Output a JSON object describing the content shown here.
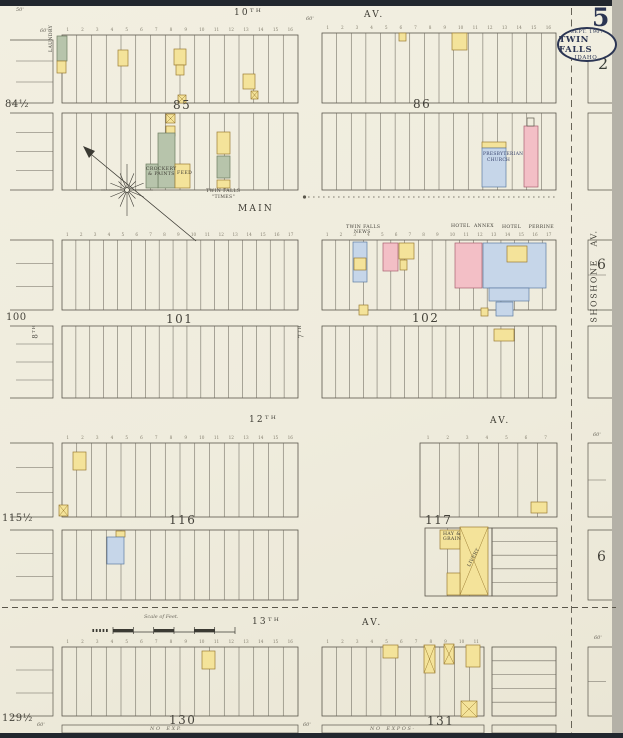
{
  "sheet": {
    "number": "5",
    "adjacent_sheet": "2",
    "stamp": {
      "line1": "SEPT. 1907",
      "line2": "TWIN FALLS",
      "line3": "IDAHO."
    }
  },
  "palette": {
    "paper": "#f0edde",
    "ink": "#5a564b",
    "ink_light": "#6b675c",
    "navy": "#2b3553",
    "yellow": "#f4e39a",
    "yellow_stroke": "#9c7d33",
    "pink": "#f3bfc6",
    "pink_stroke": "#a86070",
    "blue": "#c6d6e9",
    "blue_stroke": "#5d7ca3",
    "green": "#b7c4ab",
    "green_stroke": "#6c7c60"
  },
  "numbers": {
    "n7": [
      "1",
      "2",
      "3",
      "4",
      "5",
      "6",
      "7"
    ],
    "n11": [
      "1",
      "2",
      "3",
      "4",
      "5",
      "6",
      "7",
      "8",
      "9",
      "10",
      "11"
    ],
    "n16": [
      "1",
      "2",
      "3",
      "4",
      "5",
      "6",
      "7",
      "8",
      "9",
      "10",
      "11",
      "12",
      "13",
      "14",
      "15",
      "16"
    ],
    "n17": [
      "1",
      "2",
      "3",
      "4",
      "5",
      "6",
      "7",
      "8",
      "9",
      "10",
      "11",
      "12",
      "13",
      "14",
      "15",
      "16",
      "17"
    ]
  },
  "labels": [
    {
      "n": "street-10th",
      "t": "10ᵀᴴ",
      "x": 234,
      "y": 9,
      "c": "street"
    },
    {
      "n": "street-10th-av",
      "t": "AV.",
      "x": 364,
      "y": 11,
      "c": "street"
    },
    {
      "n": "street-main",
      "t": "MAIN",
      "x": 238,
      "y": 205,
      "c": "street"
    },
    {
      "n": "street-12th",
      "t": "12ᵀᴴ",
      "x": 249,
      "y": 416,
      "c": "street"
    },
    {
      "n": "street-12th-av",
      "t": "AV.",
      "x": 490,
      "y": 417,
      "c": "street"
    },
    {
      "n": "street-13th",
      "t": "13ᵀᴴ",
      "x": 252,
      "y": 618,
      "c": "street"
    },
    {
      "n": "street-13th-av",
      "t": "AV.",
      "x": 362,
      "y": 619,
      "c": "street"
    },
    {
      "n": "street-shoshone",
      "t": "SHOSHONE   AV.",
      "x": 548,
      "y": 272,
      "c": "streetv",
      "r": -90
    },
    {
      "n": "street-7th",
      "t": "7ᵀᴴ",
      "x": 295,
      "y": 328,
      "c": "tinyv",
      "r": -90
    },
    {
      "n": "street-8th",
      "t": "8ᵀᴴ",
      "x": 29,
      "y": 328,
      "c": "tinyv",
      "r": -90
    },
    {
      "n": "block-85",
      "t": "85",
      "x": 173,
      "y": 99,
      "c": "bn"
    },
    {
      "n": "block-86",
      "t": "86",
      "x": 413,
      "y": 98,
      "c": "bn"
    },
    {
      "n": "block-101",
      "t": "101",
      "x": 166,
      "y": 313,
      "c": "bn"
    },
    {
      "n": "block-102",
      "t": "102",
      "x": 412,
      "y": 312,
      "c": "bn"
    },
    {
      "n": "block-116",
      "t": "116",
      "x": 169,
      "y": 514,
      "c": "bn"
    },
    {
      "n": "block-117",
      "t": "117",
      "x": 425,
      "y": 514,
      "c": "bn"
    },
    {
      "n": "block-130",
      "t": "130",
      "x": 169,
      "y": 714,
      "c": "bn"
    },
    {
      "n": "block-131",
      "t": "131",
      "x": 427,
      "y": 715,
      "c": "bn"
    },
    {
      "n": "block-84half",
      "t": "84½",
      "x": 5,
      "y": 100,
      "c": "stub"
    },
    {
      "n": "block-100",
      "t": "100",
      "x": 6,
      "y": 313,
      "c": "stub"
    },
    {
      "n": "block-115half",
      "t": "115½",
      "x": 2,
      "y": 514,
      "c": "stub"
    },
    {
      "n": "block-129half",
      "t": "129½",
      "x": 2,
      "y": 714,
      "c": "stub"
    },
    {
      "n": "block-6-upper",
      "t": "6",
      "x": 597,
      "y": 258,
      "c": "big6"
    },
    {
      "n": "block-6-lower",
      "t": "6",
      "x": 597,
      "y": 550,
      "c": "big6"
    },
    {
      "n": "adjacent-sheet-2",
      "t": "2",
      "x": 598,
      "y": 56,
      "c": "adj"
    },
    {
      "n": "caption-twin-falls-times-1",
      "t": "TWIN FALLS",
      "x": 206,
      "y": 190,
      "c": "cap"
    },
    {
      "n": "caption-twin-falls-times-2",
      "t": "\"TIMES\"",
      "x": 212,
      "y": 196,
      "c": "cap"
    },
    {
      "n": "caption-twin-falls-news-1",
      "t": "TWIN FALLS",
      "x": 346,
      "y": 226,
      "c": "cap"
    },
    {
      "n": "caption-twin-falls-news-2",
      "t": "NEWS",
      "x": 354,
      "y": 231,
      "c": "cap"
    },
    {
      "n": "caption-hotel-annex",
      "t": "HOTEL  ANNEX",
      "x": 451,
      "y": 225,
      "c": "cap"
    },
    {
      "n": "caption-hotel-perrine",
      "t": "HOTEL    PERRINE",
      "x": 502,
      "y": 226,
      "c": "cap"
    },
    {
      "n": "caption-presbyterian-1",
      "t": "PRESBYTERIAN",
      "x": 483,
      "y": 153,
      "c": "capn"
    },
    {
      "n": "caption-presbyterian-2",
      "t": "CHURCH",
      "x": 487,
      "y": 159,
      "c": "capn"
    },
    {
      "n": "caption-hay-grain-1",
      "t": "HAY &",
      "x": 443,
      "y": 533,
      "c": "cap"
    },
    {
      "n": "caption-hay-grain-2",
      "t": "GRAIN",
      "x": 443,
      "y": 538,
      "c": "cap"
    },
    {
      "n": "caption-livery",
      "t": "LIVERY",
      "x": 468,
      "y": 566,
      "c": "cap",
      "r": -62
    },
    {
      "n": "caption-feed",
      "t": "FEED",
      "x": 177,
      "y": 172,
      "c": "cap"
    },
    {
      "n": "caption-crockery-1",
      "t": "CROCKERY",
      "x": 146,
      "y": 168,
      "c": "cap"
    },
    {
      "n": "caption-crockery-2",
      "t": "& PAINTS",
      "x": 148,
      "y": 173,
      "c": "cap"
    },
    {
      "n": "caption-laundry",
      "t": "LAUNDRY",
      "x": 50,
      "y": 52,
      "c": "cap",
      "r": -90
    },
    {
      "n": "caption-no-exp-left",
      "t": "N O    E X P.",
      "x": 150,
      "y": 727,
      "c": "dim"
    },
    {
      "n": "caption-no-expos-right",
      "t": "N O    E X P O S -",
      "x": 370,
      "y": 727,
      "c": "dim"
    },
    {
      "n": "scale-caption",
      "t": "Scale of Feet.",
      "x": 144,
      "y": 615,
      "c": "dim"
    },
    {
      "n": "dim-50ft",
      "t": "50'",
      "x": 16,
      "y": 8,
      "c": "dim"
    },
    {
      "n": "dim-60ft-a",
      "t": "60'",
      "x": 40,
      "y": 29,
      "c": "dim"
    },
    {
      "n": "dim-60ft-b",
      "t": "60'",
      "x": 306,
      "y": 17,
      "c": "dim"
    },
    {
      "n": "dim-60ft-c",
      "t": "60'",
      "x": 37,
      "y": 723,
      "c": "dim"
    },
    {
      "n": "dim-60ft-d",
      "t": "60'",
      "x": 303,
      "y": 723,
      "c": "dim"
    },
    {
      "n": "dim-60ft-e",
      "t": "60'",
      "x": 593,
      "y": 433,
      "c": "dim"
    },
    {
      "n": "dim-60ft-f",
      "t": "60'",
      "x": 594,
      "y": 636,
      "c": "dim"
    }
  ],
  "map": {
    "blocks": [
      {
        "x": 62,
        "y": 35,
        "w": 236,
        "h": 68,
        "lots": 16
      },
      {
        "x": 62,
        "y": 113,
        "w": 236,
        "h": 77,
        "lots": 16
      },
      {
        "x": 322,
        "y": 33,
        "w": 234,
        "h": 70,
        "lots": 16
      },
      {
        "x": 322,
        "y": 113,
        "w": 234,
        "h": 77,
        "lots": 16
      },
      {
        "x": 62,
        "y": 240,
        "w": 236,
        "h": 70,
        "lots": 17
      },
      {
        "x": 62,
        "y": 326,
        "w": 236,
        "h": 72,
        "lots": 17
      },
      {
        "x": 322,
        "y": 240,
        "w": 234,
        "h": 70,
        "lots": 17
      },
      {
        "x": 322,
        "y": 326,
        "w": 234,
        "h": 72,
        "lots": 17
      },
      {
        "x": 62,
        "y": 443,
        "w": 236,
        "h": 74,
        "lots": 16
      },
      {
        "x": 62,
        "y": 530,
        "w": 236,
        "h": 70,
        "lots": 16
      },
      {
        "x": 420,
        "y": 443,
        "w": 137,
        "h": 74,
        "lots": 7
      },
      {
        "x": 425,
        "y": 528,
        "w": 67,
        "h": 68,
        "lots": 3
      },
      {
        "x": 62,
        "y": 647,
        "w": 236,
        "h": 69,
        "lots": 16
      },
      {
        "x": 322,
        "y": 647,
        "w": 162,
        "h": 69,
        "lots": 11
      }
    ],
    "rows_blocks": [
      {
        "x": 492,
        "y": 528,
        "w": 65,
        "h": 68,
        "rows": 5
      },
      {
        "x": 492,
        "y": 647,
        "w": 64,
        "h": 69,
        "rows": 5
      }
    ],
    "strips": [
      {
        "x": 62,
        "y": 725,
        "w": 236,
        "h": 8
      },
      {
        "x": 322,
        "y": 725,
        "w": 162,
        "h": 8
      },
      {
        "x": 492,
        "y": 725,
        "w": 64,
        "h": 8
      }
    ],
    "stubs_left": [
      {
        "x": 10,
        "y": 40,
        "w": 43,
        "h": 63,
        "inner": 2
      },
      {
        "x": 10,
        "y": 113,
        "w": 43,
        "h": 77,
        "inner": 3
      },
      {
        "x": 10,
        "y": 240,
        "w": 43,
        "h": 70,
        "inner": 2
      },
      {
        "x": 10,
        "y": 326,
        "w": 43,
        "h": 72,
        "inner": 3
      },
      {
        "x": 10,
        "y": 443,
        "w": 43,
        "h": 74,
        "inner": 2
      },
      {
        "x": 10,
        "y": 530,
        "w": 43,
        "h": 70,
        "inner": 2
      },
      {
        "x": 10,
        "y": 647,
        "w": 43,
        "h": 69,
        "inner": 2
      }
    ],
    "stubs_right": [
      {
        "x": 588,
        "y": 35,
        "w": 24,
        "h": 68,
        "inner": 0
      },
      {
        "x": 588,
        "y": 113,
        "w": 24,
        "h": 77,
        "inner": 0
      },
      {
        "x": 588,
        "y": 240,
        "w": 24,
        "h": 70,
        "inner": 1
      },
      {
        "x": 588,
        "y": 326,
        "w": 24,
        "h": 72,
        "inner": 0
      },
      {
        "x": 588,
        "y": 443,
        "w": 24,
        "h": 74,
        "inner": 1
      },
      {
        "x": 588,
        "y": 530,
        "w": 24,
        "h": 70,
        "inner": 0
      },
      {
        "x": 588,
        "y": 647,
        "w": 24,
        "h": 69,
        "inner": 1
      }
    ],
    "buildings": [
      [
        57,
        36,
        10,
        25,
        "G",
        0
      ],
      [
        57,
        61,
        9,
        12,
        "Y",
        0
      ],
      [
        118,
        50,
        10,
        16,
        "Y",
        0
      ],
      [
        174,
        49,
        12,
        16,
        "Y",
        0
      ],
      [
        176,
        65,
        8,
        10,
        "Y",
        0
      ],
      [
        243,
        74,
        12,
        15,
        "Y",
        0
      ],
      [
        251,
        91,
        7,
        8,
        "Y",
        1
      ],
      [
        178,
        95,
        8,
        8,
        "Y",
        1
      ],
      [
        166,
        114,
        9,
        9,
        "Y",
        1
      ],
      [
        166,
        126,
        9,
        10,
        "Y",
        0
      ],
      [
        158,
        133,
        17,
        55,
        "G",
        0
      ],
      [
        146,
        164,
        12,
        24,
        "G",
        0
      ],
      [
        175,
        164,
        15,
        24,
        "Y",
        0
      ],
      [
        217,
        132,
        13,
        22,
        "Y",
        0
      ],
      [
        217,
        156,
        13,
        22,
        "G",
        0
      ],
      [
        217,
        180,
        13,
        8,
        "Y",
        0
      ],
      [
        399,
        33,
        7,
        8,
        "Y",
        0
      ],
      [
        452,
        33,
        15,
        17,
        "Y",
        0
      ],
      [
        482,
        142,
        24,
        6,
        "Y",
        0
      ],
      [
        482,
        148,
        24,
        39,
        "B",
        0
      ],
      [
        524,
        126,
        14,
        61,
        "P",
        0
      ],
      [
        527,
        118,
        7,
        8,
        "W",
        0
      ],
      [
        353,
        242,
        14,
        40,
        "B",
        0
      ],
      [
        354,
        258,
        12,
        12,
        "Y",
        0
      ],
      [
        383,
        243,
        15,
        28,
        "P",
        0
      ],
      [
        399,
        243,
        15,
        16,
        "Y",
        0
      ],
      [
        400,
        260,
        7,
        10,
        "Y",
        0
      ],
      [
        455,
        243,
        27,
        45,
        "P",
        0
      ],
      [
        483,
        243,
        63,
        45,
        "B",
        0
      ],
      [
        507,
        246,
        20,
        16,
        "Y",
        0
      ],
      [
        489,
        288,
        40,
        13,
        "B",
        0
      ],
      [
        496,
        302,
        17,
        14,
        "B",
        0
      ],
      [
        481,
        308,
        7,
        8,
        "Y",
        0
      ],
      [
        359,
        305,
        9,
        10,
        "Y",
        0
      ],
      [
        494,
        329,
        20,
        12,
        "Y",
        0
      ],
      [
        73,
        452,
        13,
        18,
        "Y",
        0
      ],
      [
        59,
        505,
        9,
        11,
        "Y",
        1
      ],
      [
        116,
        531,
        9,
        6,
        "Y",
        0
      ],
      [
        107,
        537,
        17,
        27,
        "B",
        0
      ],
      [
        531,
        502,
        16,
        11,
        "Y",
        0
      ],
      [
        440,
        530,
        20,
        19,
        "Y",
        0
      ],
      [
        460,
        527,
        28,
        68,
        "Y",
        1
      ],
      [
        447,
        573,
        13,
        22,
        "Y",
        0
      ],
      [
        202,
        651,
        13,
        18,
        "Y",
        0
      ],
      [
        383,
        645,
        15,
        13,
        "Y",
        0
      ],
      [
        424,
        645,
        11,
        28,
        "Y",
        1
      ],
      [
        444,
        644,
        10,
        20,
        "Y",
        1
      ],
      [
        466,
        645,
        14,
        22,
        "Y",
        0
      ],
      [
        461,
        701,
        16,
        16,
        "Y",
        1
      ]
    ],
    "lot_rows": [
      {
        "x": 62,
        "y": 28,
        "w": 236,
        "n": "n16"
      },
      {
        "x": 322,
        "y": 26,
        "w": 234,
        "n": "n16"
      },
      {
        "x": 62,
        "y": 233,
        "w": 236,
        "n": "n17"
      },
      {
        "x": 322,
        "y": 233,
        "w": 234,
        "n": "n17"
      },
      {
        "x": 62,
        "y": 436,
        "w": 236,
        "n": "n16"
      },
      {
        "x": 420,
        "y": 436,
        "w": 137,
        "n": "n7"
      },
      {
        "x": 62,
        "y": 640,
        "w": 236,
        "n": "n16"
      },
      {
        "x": 322,
        "y": 640,
        "w": 162,
        "n": "n11"
      }
    ],
    "compass": {
      "cx": 127,
      "cy": 190,
      "tail_x": 196,
      "tail_y": 241,
      "tip_x": 86,
      "tip_y": 150
    },
    "scale_bar": {
      "x": 113,
      "y": 629,
      "w": 122,
      "segments": 6
    },
    "lines": {
      "shoshone_dash": {
        "x": 571.5,
        "y1": 8,
        "y2": 733
      },
      "bottom_dash": {
        "y": 607.5,
        "x1": 2,
        "x2": 616
      },
      "main_dotdash": {
        "y": 197,
        "x1": 308,
        "x2": 556,
        "dot_x": 304.5
      }
    }
  }
}
